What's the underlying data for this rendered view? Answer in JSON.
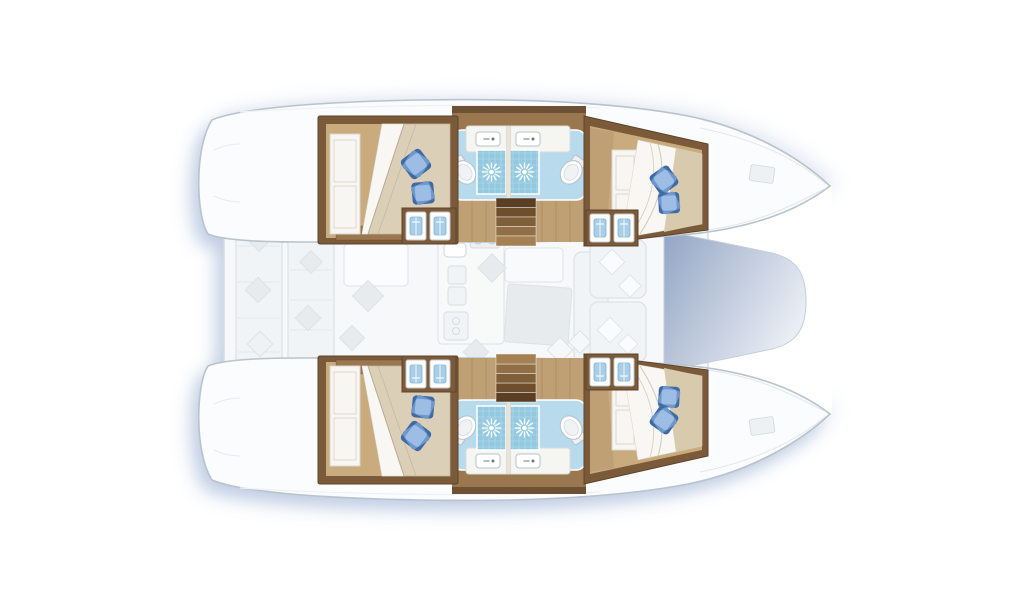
{
  "palette": {
    "hull-fill": "#fbfcfd",
    "hull-stroke": "#b9c3cc",
    "shadow": "#b5c5df",
    "deck-fill": "#f6f8f9",
    "deck-stroke": "#d7dce0",
    "faded-fill": "#f1f4f6",
    "faded-fill2": "#e7ebee",
    "faded-stroke": "#dde2e6",
    "wood-dark": "#7b5a39",
    "wood-mid": "#9a774e",
    "wood-light": "#bf9f74",
    "cabin-floor": "#c9ab7e",
    "blanket": "#dccfb8",
    "sheet": "#f8f7f3",
    "counter": "#f5f5f2",
    "bath-floor": "#b7dbec",
    "shower": "#92c9e0",
    "towel": "#a9cfe8",
    "pillow-light": "#9dbde4",
    "pillow-mid": "#6e97cc",
    "pillow-dark": "#3f6aa6",
    "tramp-start": "#93a5c4",
    "tramp-end": "#e9edf4",
    "stair-1": "#5a3f24",
    "stair-2": "#6d4e2d",
    "stair-3": "#7f5f3a",
    "stair-4": "#916f46",
    "stair-5": "#a48054"
  },
  "areas": {
    "hulls": [
      "port-hull",
      "starboard-hull"
    ],
    "cabins": [
      "aft-port-cabin",
      "forward-port-cabin",
      "aft-starboard-cabin",
      "forward-starboard-cabin"
    ],
    "berth_count": 4,
    "bathroom_count": 4,
    "shower_count": 4,
    "toilet_count": 4,
    "washbasin_count": 4,
    "staircase_count": 2,
    "deck_zones": [
      "aft-cockpit",
      "saloon",
      "galley",
      "dining-table",
      "foredeck-lounge",
      "trampoline"
    ]
  }
}
